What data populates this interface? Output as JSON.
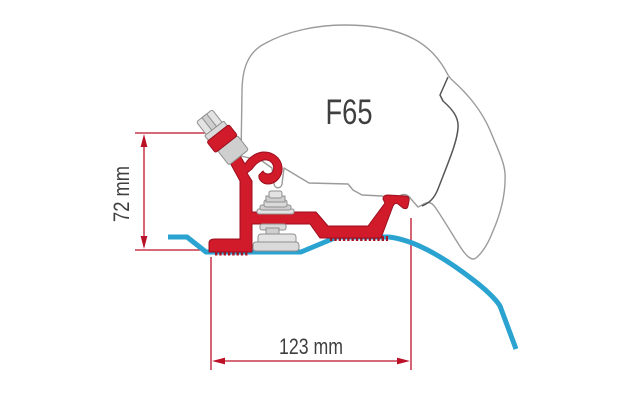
{
  "diagram": {
    "product_label": "F65",
    "annotations": {
      "height_dimension": "72 mm",
      "width_dimension": "123 mm"
    },
    "colors": {
      "bracket_red": "#d11a2a",
      "bracket_edge_red": "#9c0f1f",
      "dimension_red": "#bc1228",
      "roof_profile_blue": "#2aa3d1",
      "case_outline_gray": "#9b9b9b",
      "case_seam_gray": "#555555",
      "hardware_gray": "#dadada",
      "label_text": "#3f3f3f",
      "background": "#ffffff"
    },
    "parts": [
      "awning-case",
      "awning-case-seam",
      "adapter-bracket",
      "front-rail-hook",
      "rear-rail-hook",
      "serrated-mounting-foot",
      "clamp-bolt-assembly",
      "fixing-knob",
      "roof-clamp",
      "vehicle-roof-profile",
      "height-dimension",
      "width-dimension"
    ]
  }
}
